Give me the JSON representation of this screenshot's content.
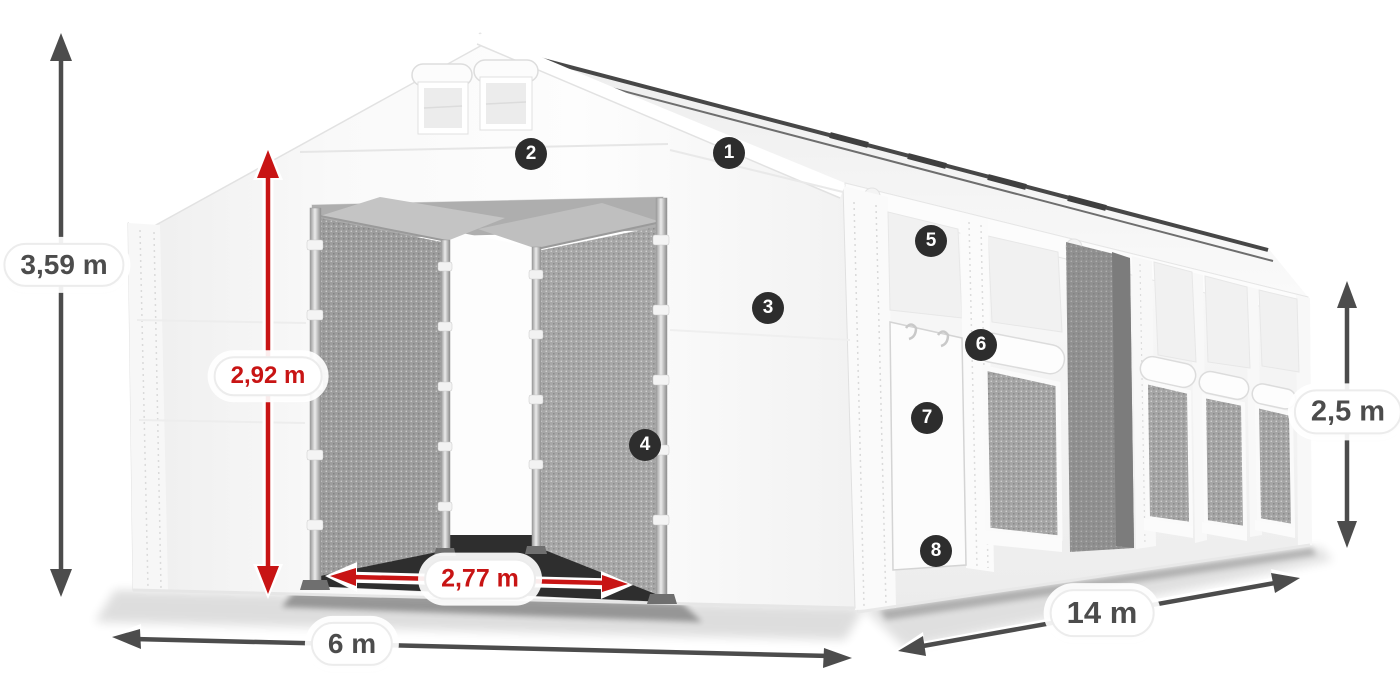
{
  "dimensions": {
    "total_height": {
      "label": "3,59 m"
    },
    "entrance_height": {
      "label": "2,92 m"
    },
    "entrance_width": {
      "label": "2,77 m"
    },
    "width": {
      "label": "6 m"
    },
    "length": {
      "label": "14 m"
    },
    "side_height": {
      "label": "2,5 m"
    }
  },
  "feature_markers": [
    {
      "number": "1"
    },
    {
      "number": "2"
    },
    {
      "number": "3"
    },
    {
      "number": "4"
    },
    {
      "number": "5"
    },
    {
      "number": "6"
    },
    {
      "number": "7"
    },
    {
      "number": "8"
    }
  ],
  "colors": {
    "dimension_red": "#c81414",
    "dimension_gray": "#4c4c4c",
    "marker_background": "#2d2d2d",
    "marker_text": "#ffffff",
    "tent_white": "#f7f7f7",
    "mesh_gray": "#9f9f9f"
  }
}
